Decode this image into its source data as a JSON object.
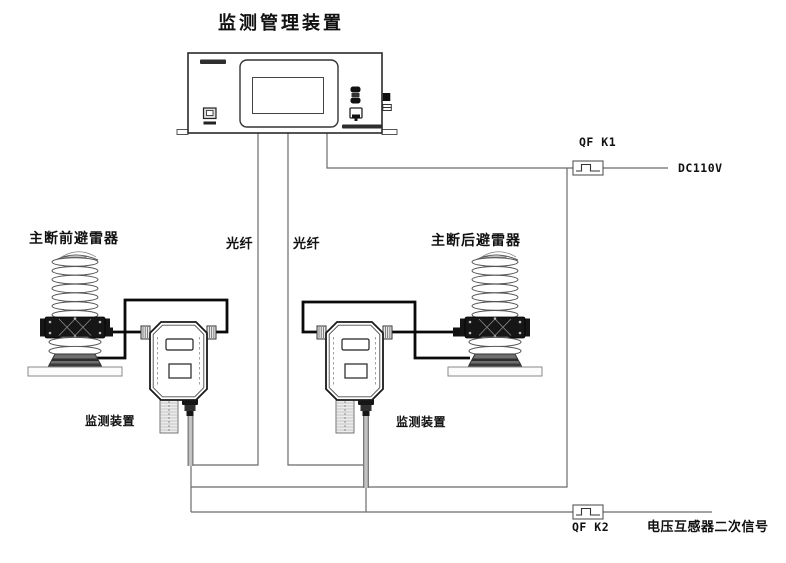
{
  "title": "监测管理装置",
  "arresters": {
    "left_label": "主断前避雷器",
    "right_label": "主断后避雷器"
  },
  "monitors": {
    "left_label": "监测装置",
    "right_label": "监测装置"
  },
  "fibers": {
    "left_label": "光纤",
    "right_label": "光纤"
  },
  "power_circuit": {
    "breaker_label": "QF K1",
    "source_label": "DC110V"
  },
  "signal_circuit": {
    "breaker_label": "QF K2",
    "source_label": "电压互感器二次信号"
  },
  "colors": {
    "background": "#ffffff",
    "thin_line": "#6a6a6a",
    "thick_line": "#0a0a0a",
    "cable_gray": "#c2c2c2",
    "text": "#111111"
  }
}
